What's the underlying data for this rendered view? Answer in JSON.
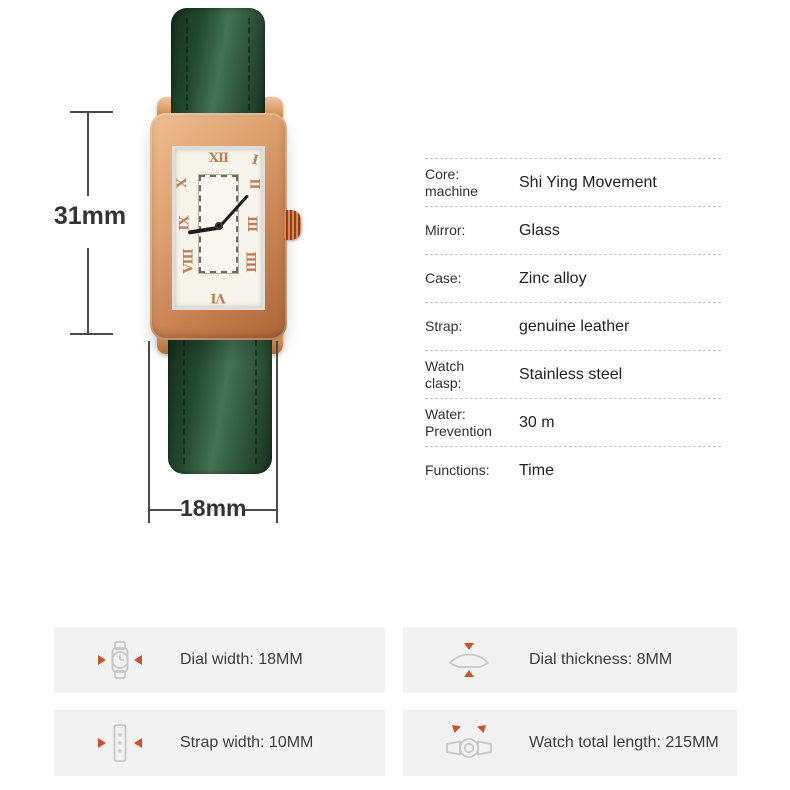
{
  "watch": {
    "numerals": {
      "n12": "XII",
      "n1": "I",
      "n2": "II",
      "n3": "III",
      "n4": "IIII",
      "n6": "VI",
      "n8": "VIII",
      "n9": "IX",
      "n10": "X"
    },
    "colors": {
      "strap_green": "#2b5138",
      "case_rose_gold": "#cf8a5f",
      "dial": "#f7f4ec",
      "numerals": "#c07d53"
    }
  },
  "dimensions": {
    "height": "31mm",
    "width": "18mm"
  },
  "specs": {
    "rows": [
      {
        "label": "Core:\nmachine",
        "value": "Shi Ying Movement"
      },
      {
        "label": "Mirror:",
        "value": "Glass"
      },
      {
        "label": "Case:",
        "value": "Zinc alloy"
      },
      {
        "label": "Strap:",
        "value": "genuine leather"
      },
      {
        "label": "Watch\nclasp:",
        "value": "Stainless steel"
      },
      {
        "label": "Water:\nPrevention",
        "value": "30 m"
      },
      {
        "label": "Functions:",
        "value": "Time"
      }
    ]
  },
  "features": {
    "accent": "#cf4f2b",
    "box_background": "#f2f2f2",
    "items": [
      {
        "icon": "dial-width-icon",
        "label": "Dial width: 18MM"
      },
      {
        "icon": "dial-thickness-icon",
        "label": "Dial thickness: 8MM"
      },
      {
        "icon": "strap-width-icon",
        "label": "Strap width: 10MM"
      },
      {
        "icon": "watch-total-length-icon",
        "label": "Watch total length: 215MM"
      }
    ]
  }
}
